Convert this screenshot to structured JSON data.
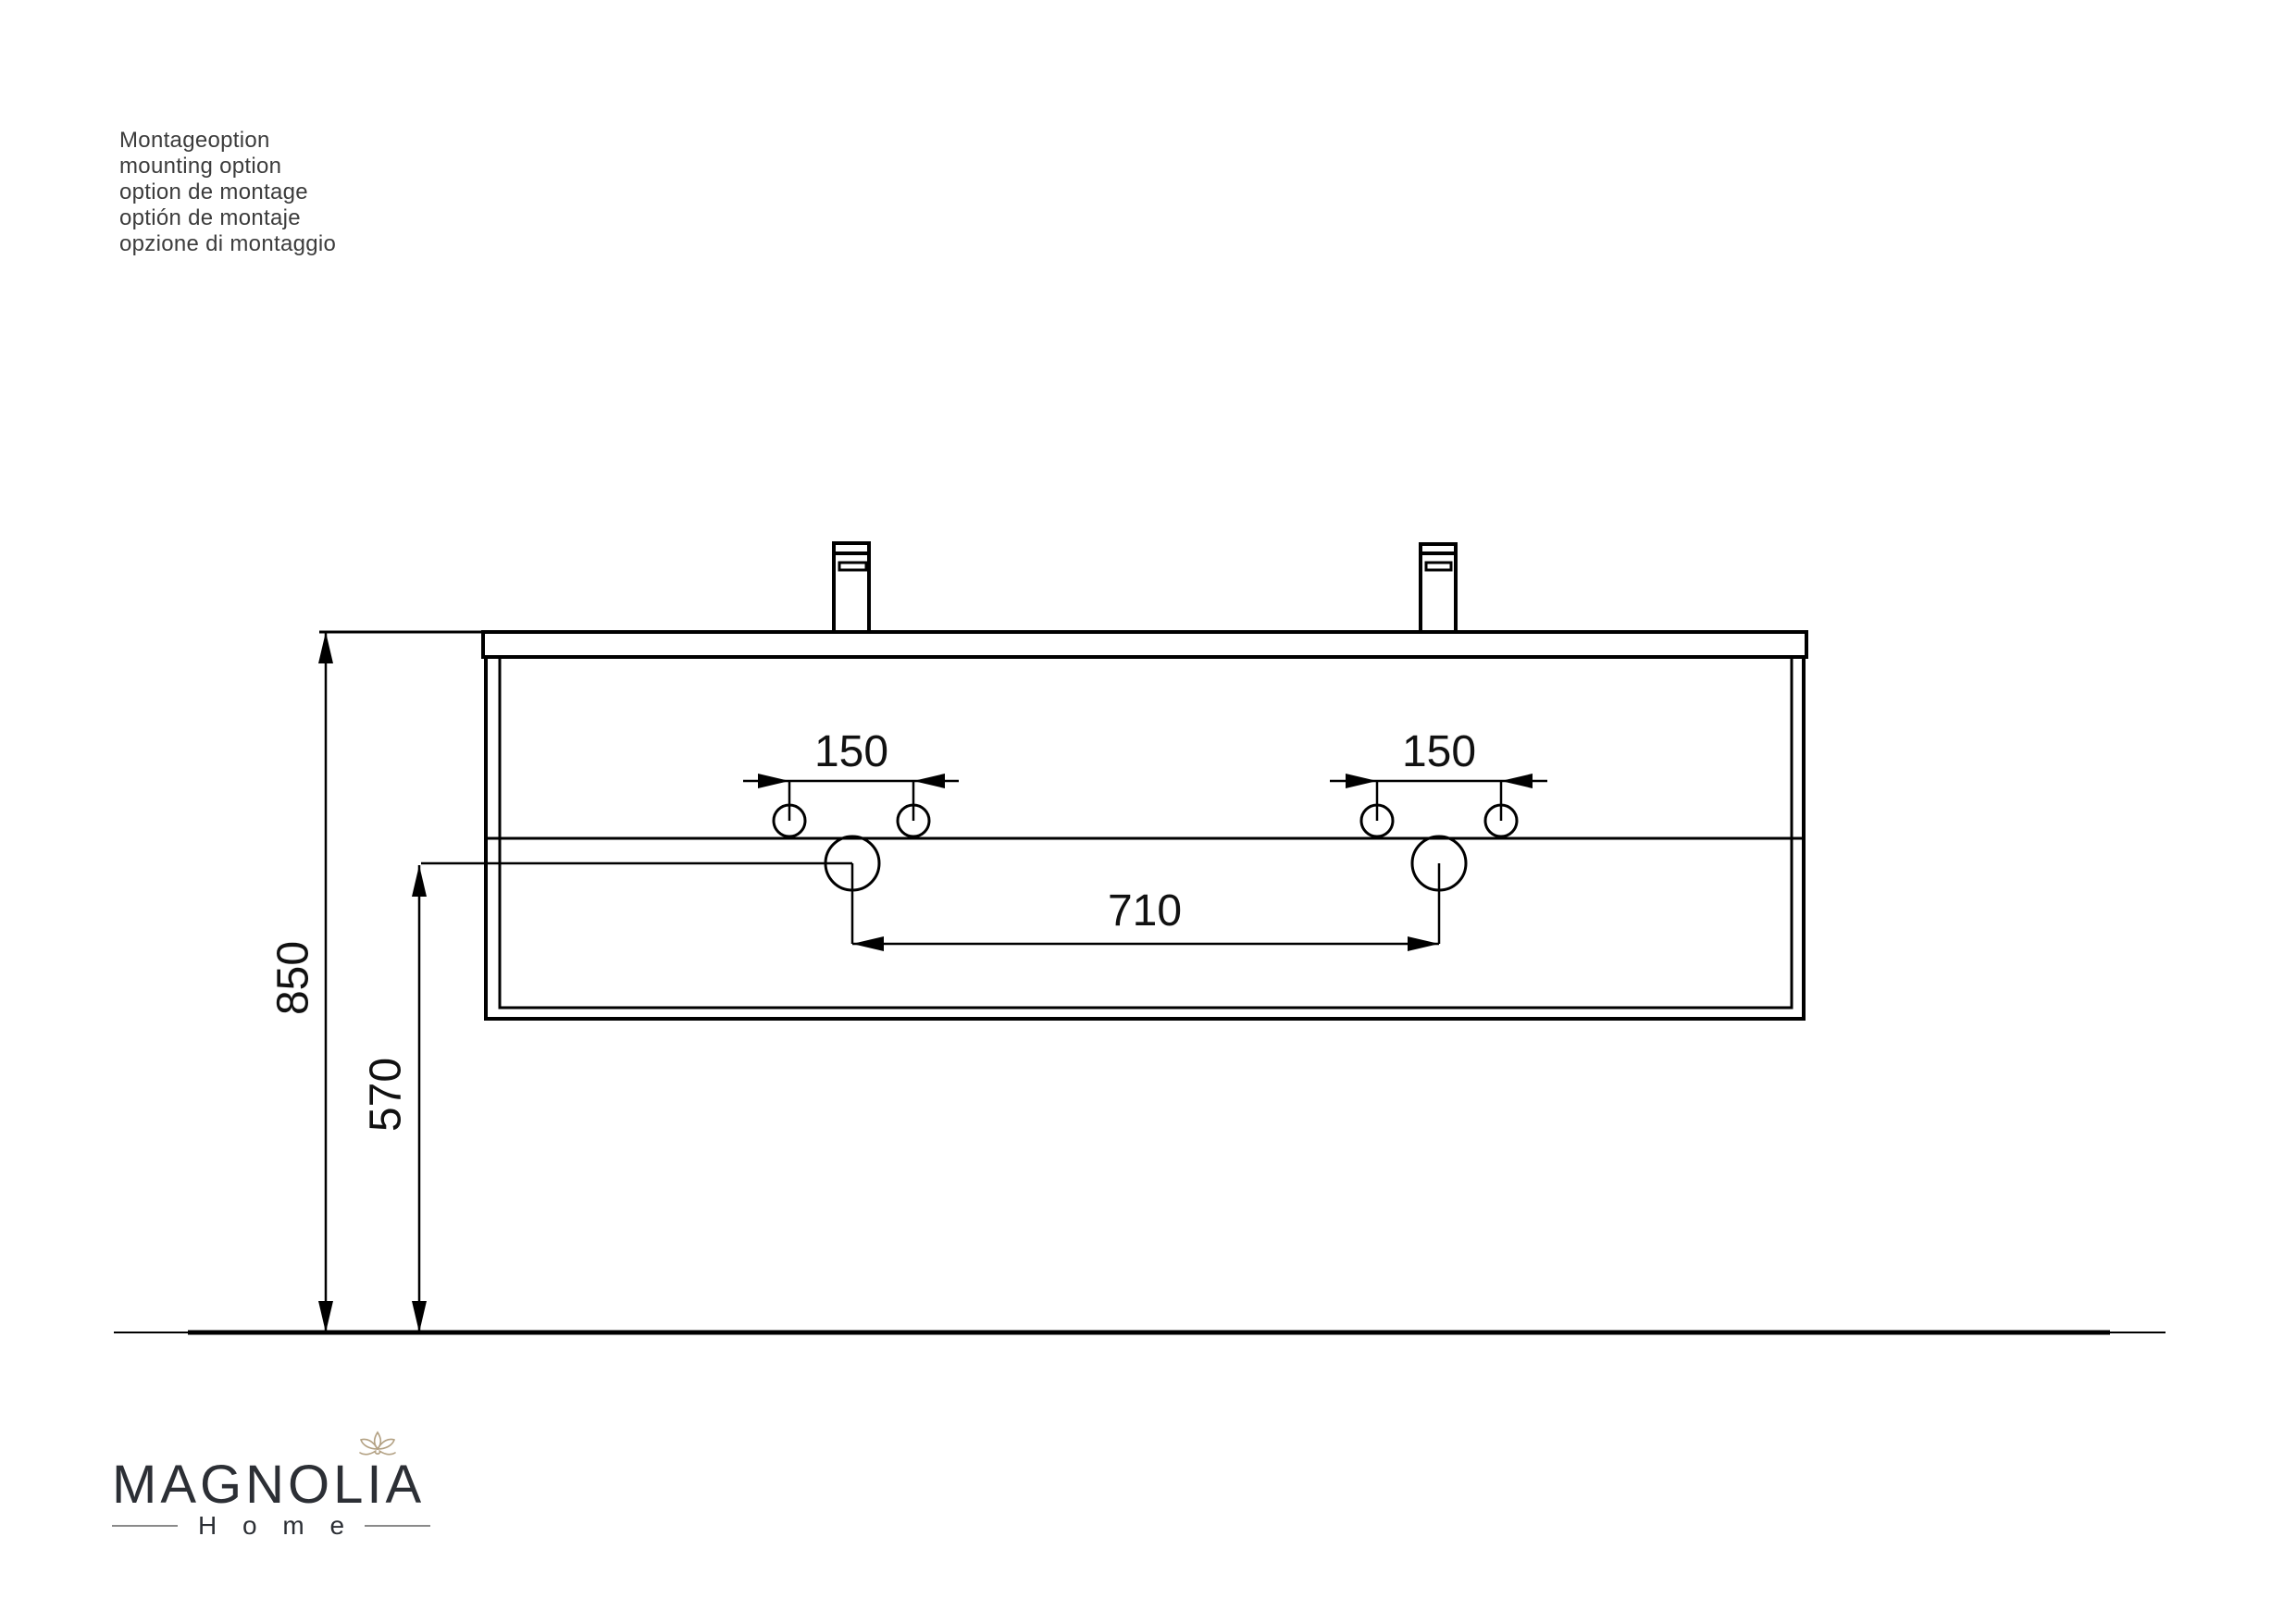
{
  "title_block": {
    "lines": [
      "Montageoption",
      "mounting option",
      "option de montage",
      "optión de montaje",
      "opzione di montaggio"
    ]
  },
  "drawing": {
    "type": "technical-drawing",
    "subject": "wall-mounted double washbasin vanity, front elevation with mounting dimensions",
    "dimensions": {
      "floor_to_counter_top": "850",
      "floor_to_drain_center": "570",
      "left_faucet_hole_spacing": "150",
      "right_faucet_hole_spacing": "150",
      "drain_center_spacing": "710"
    }
  },
  "logo": {
    "brand": "MAGNOLIA",
    "subtitle": "H o m e"
  },
  "colors": {
    "background": "#ffffff",
    "line": "#000000",
    "dimension_text": "#111111",
    "title_text": "#3c3c3c",
    "logo_text": "#2c2f35",
    "logo_flower": "#b3a183",
    "logo_rule": "#8a8a8a"
  }
}
